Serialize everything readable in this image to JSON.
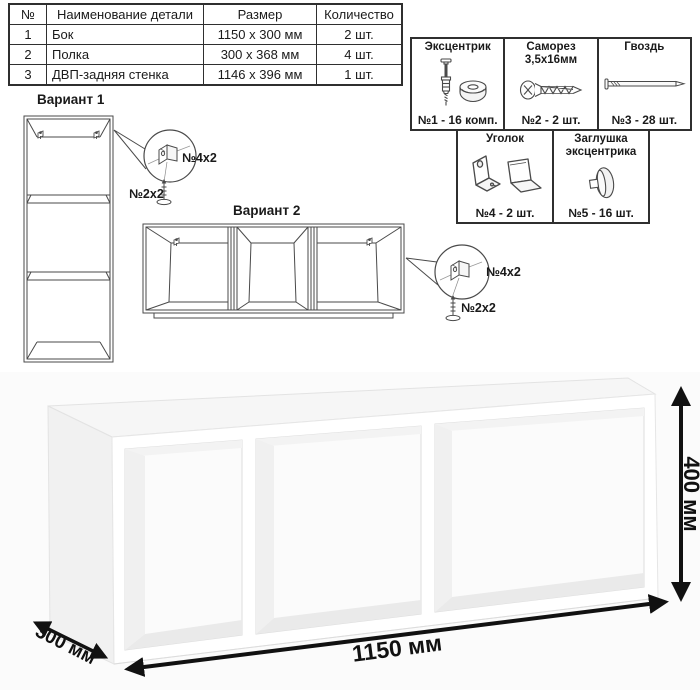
{
  "parts_table": {
    "headers": [
      "№",
      "Наименование детали",
      "Размер",
      "Количество"
    ],
    "rows": [
      {
        "num": "1",
        "name": "Бок",
        "size": "1150 х 300 мм",
        "qty": "2 шт."
      },
      {
        "num": "2",
        "name": "Полка",
        "size": "300 х 368 мм",
        "qty": "4 шт."
      },
      {
        "num": "3",
        "name": "ДВП-задняя стенка",
        "size": "1146 х 396 мм",
        "qty": "1 шт."
      }
    ]
  },
  "hardware": {
    "items": [
      {
        "title": "Эксцентрик",
        "subtitle": "",
        "count": "№1 - 16 комп.",
        "icon": "cam-fitting-icon"
      },
      {
        "title": "Саморез",
        "subtitle": "3,5х16мм",
        "count": "№2 - 2 шт.",
        "icon": "screw-icon"
      },
      {
        "title": "Гвоздь",
        "subtitle": "",
        "count": "№3 - 28 шт.",
        "icon": "nail-icon"
      },
      {
        "title": "Уголок",
        "subtitle": "",
        "count": "№4 - 2 шт.",
        "icon": "corner-bracket-icon"
      },
      {
        "title": "Заглушка",
        "subtitle": "эксцентрика",
        "count": "№5 - 16 шт.",
        "icon": "cam-cap-icon"
      }
    ]
  },
  "variants": {
    "v1": {
      "title": "Вариант 1",
      "bracket_label": "№4х2",
      "screw_label": "№2х2"
    },
    "v2": {
      "title": "Вариант 2",
      "bracket_label": "№4х2",
      "screw_label": "№2х2"
    }
  },
  "dimensions": {
    "width": "1150 мм",
    "height": "400 мм",
    "depth": "300 мм"
  },
  "colors": {
    "line": "#4a4a4a",
    "border": "#2f2f2f",
    "arrow": "#111111"
  }
}
